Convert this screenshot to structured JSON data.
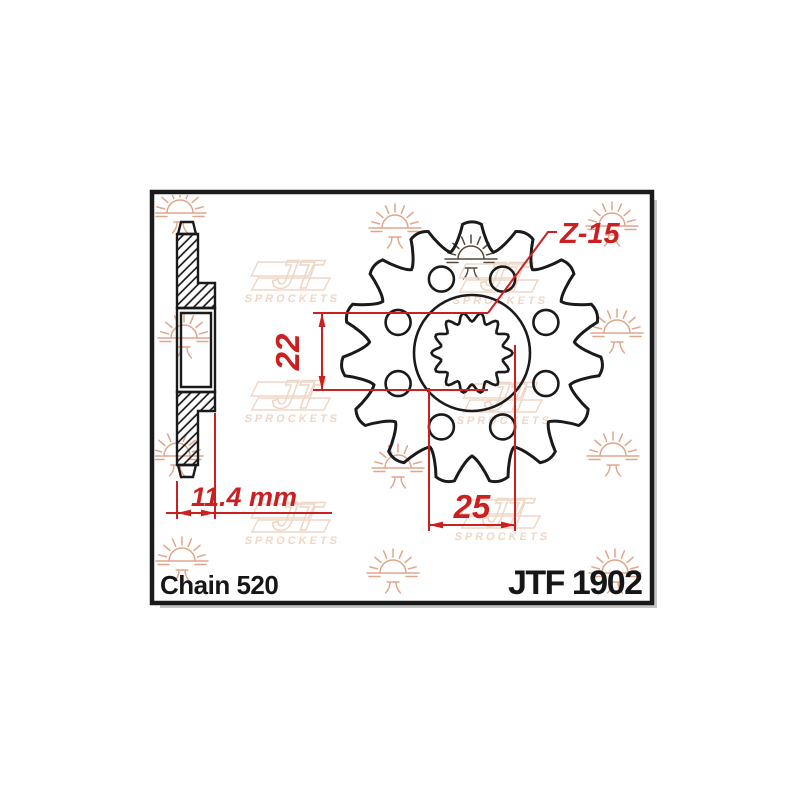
{
  "meta": {
    "description": "JT Sprockets front sprocket technical drawing"
  },
  "labels": {
    "chain_type": "Chain 520",
    "part_number": "JTF 1902"
  },
  "dimensions": {
    "teeth_label": {
      "text": "Z-15"
    },
    "bore_height": {
      "text": "22"
    },
    "bore_width": {
      "text": "25"
    },
    "thickness": {
      "text": "11.4 mm"
    }
  },
  "colors": {
    "ink": "#1a1a1a",
    "dimension_red": "#cc1f1f",
    "watermark_shield": "#eed7c6",
    "watermark_sun": "#dfa68b",
    "watermark_sun_dark": "#57493e",
    "frame_shadow": "#c6c6c6",
    "paper": "#ffffff"
  },
  "watermark": {
    "brand": "JT",
    "brand_sub": "SPROCKETS",
    "sun_glyph": "兀",
    "suns": [
      [
        180,
        213
      ],
      [
        395,
        228
      ],
      [
        612,
        226
      ],
      [
        184,
        338
      ],
      [
        617,
        333
      ],
      [
        177,
        456
      ],
      [
        398,
        468
      ],
      [
        613,
        456
      ],
      [
        182,
        561
      ],
      [
        393,
        573
      ],
      [
        615,
        573
      ]
    ],
    "dark_sun": [
      471,
      259
    ],
    "shields": [
      [
        300,
        278
      ],
      [
        508,
        280
      ],
      [
        300,
        398
      ],
      [
        512,
        400
      ],
      [
        300,
        520
      ],
      [
        510,
        516
      ]
    ]
  },
  "sprocket": {
    "teeth_count": 15,
    "holes_count": 8,
    "front_view": {
      "cx": 472,
      "cy": 353,
      "tip_r": 129,
      "root_r": 103,
      "hub_r": 58,
      "hole_r": 12.5,
      "hole_circle_r": 80,
      "hole_angle_offset": 22.5,
      "spline_base_r": 36,
      "spline_amp": 4.5,
      "spline_lobes": 14
    },
    "side_view": {
      "outline_parts": [
        {
          "name": "tooth-tip-top",
          "pts": [
            [
              181,
              222
            ],
            [
              193,
              222
            ],
            [
              196,
              234
            ],
            [
              178,
              234
            ]
          ],
          "hatch": false
        },
        {
          "name": "upper-web",
          "pts": [
            [
              177,
              234
            ],
            [
              198,
              234
            ],
            [
              198,
              283
            ],
            [
              215,
              283
            ],
            [
              215,
              308
            ],
            [
              177,
              308
            ]
          ],
          "hatch": true
        },
        {
          "name": "hub-outer",
          "pts": [
            [
              177,
              308
            ],
            [
              215,
              308
            ],
            [
              215,
              392
            ],
            [
              177,
              392
            ]
          ],
          "hatch": false
        },
        {
          "name": "hub-bore",
          "pts": [
            [
              181,
              313
            ],
            [
              211,
              313
            ],
            [
              211,
              387
            ],
            [
              181,
              387
            ]
          ],
          "hatch": false
        },
        {
          "name": "lower-web",
          "pts": [
            [
              177,
              392
            ],
            [
              215,
              392
            ],
            [
              215,
              411
            ],
            [
              198,
              411
            ],
            [
              198,
              465
            ],
            [
              177,
              465
            ]
          ],
          "hatch": true
        },
        {
          "name": "tooth-tip-bottom",
          "pts": [
            [
              178,
              465
            ],
            [
              196,
              465
            ],
            [
              193,
              477
            ],
            [
              181,
              477
            ]
          ],
          "hatch": false
        }
      ]
    }
  },
  "dims_geometry": {
    "lines": [
      [
        313,
        313,
        488,
        313
      ],
      [
        313,
        390,
        488,
        390
      ],
      [
        322,
        313,
        322,
        390
      ],
      [
        429,
        388,
        429,
        531
      ],
      [
        515,
        345,
        515,
        531
      ],
      [
        429,
        525,
        515,
        525
      ],
      [
        177,
        481,
        177,
        519
      ],
      [
        215,
        413,
        215,
        519
      ],
      [
        166,
        513,
        332,
        513
      ]
    ],
    "leader": [
      [
        488,
        313
      ],
      [
        548,
        232
      ],
      [
        557,
        232
      ]
    ],
    "arrows": [
      [
        322,
        313,
        90
      ],
      [
        322,
        390,
        270
      ],
      [
        429,
        525,
        180
      ],
      [
        515,
        525,
        0
      ],
      [
        177,
        513,
        180
      ],
      [
        215,
        513,
        0
      ]
    ]
  },
  "frame": {
    "x": 152,
    "y": 192,
    "w": 500,
    "h": 411
  }
}
